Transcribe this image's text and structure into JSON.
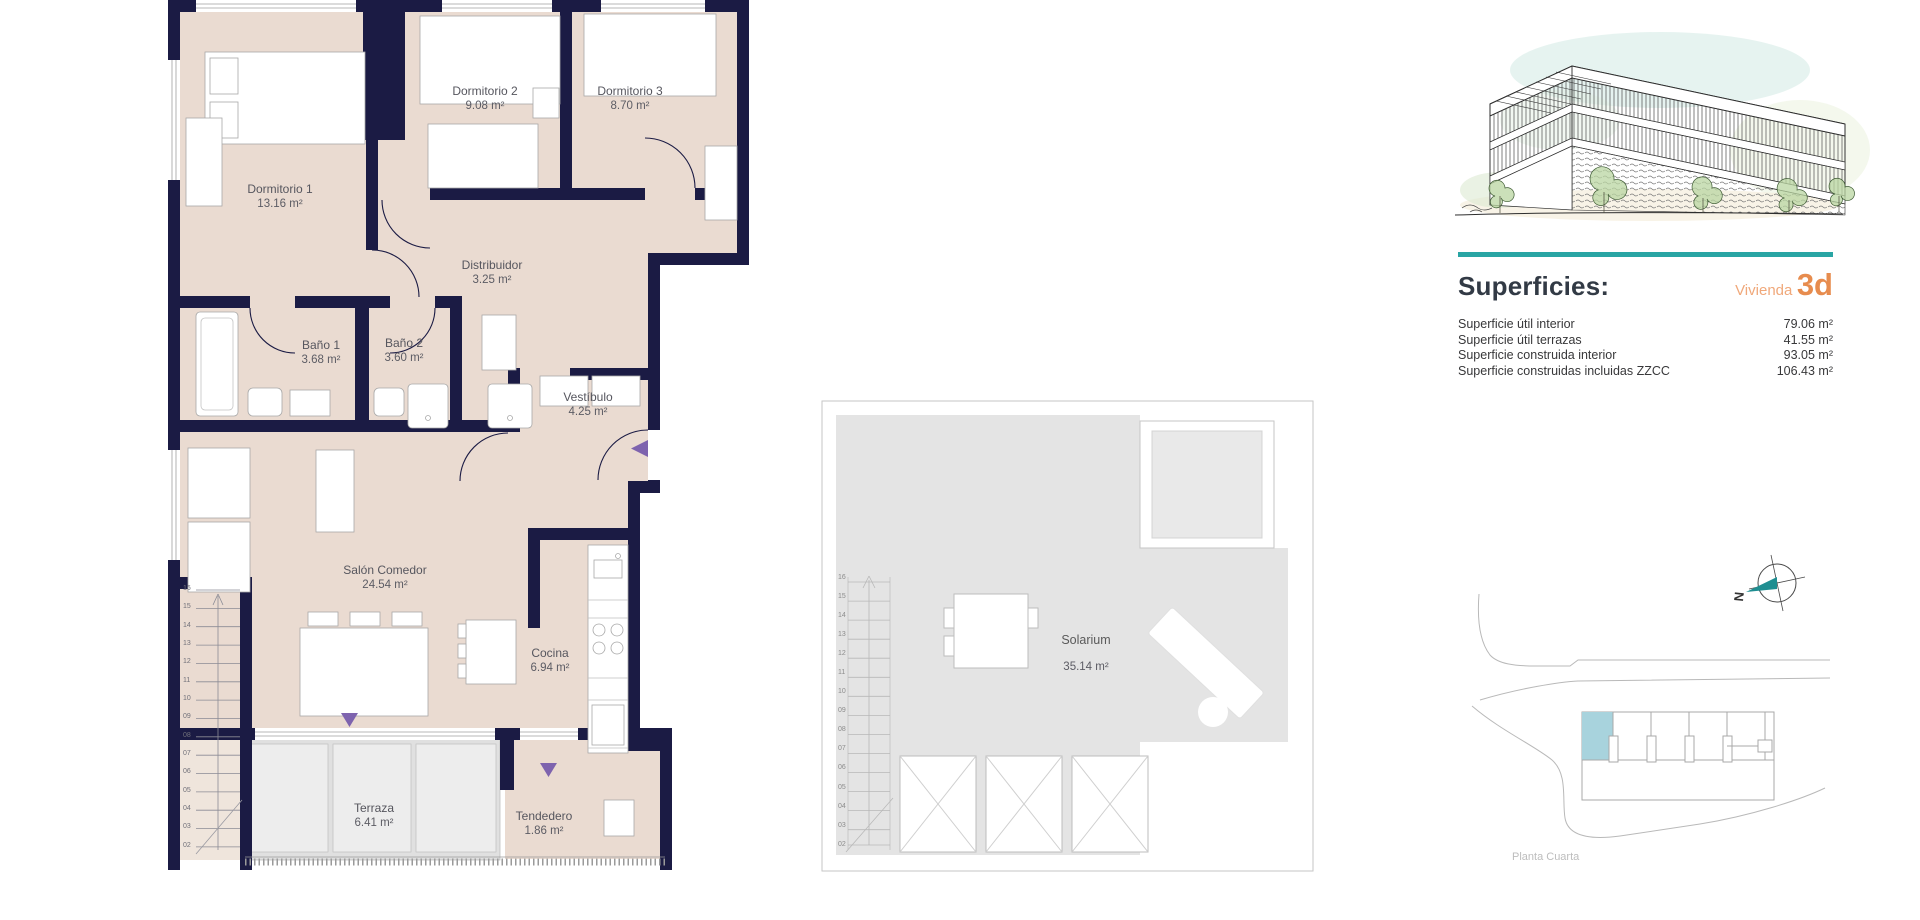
{
  "apartment_plan": {
    "rooms": [
      {
        "name": "Dormitorio 1",
        "area": "13.16 m²"
      },
      {
        "name": "Dormitorio 2",
        "area": "9.08 m²"
      },
      {
        "name": "Dormitorio 3",
        "area": "8.70 m²"
      },
      {
        "name": "Distribuidor",
        "area": "3.25 m²"
      },
      {
        "name": "Baño 1",
        "area": "3.68 m²"
      },
      {
        "name": "Baño 2",
        "area": "3.60 m²"
      },
      {
        "name": "Vestíbulo",
        "area": "4.25 m²"
      },
      {
        "name": "Salón Comedor",
        "area": "24.54 m²"
      },
      {
        "name": "Cocina",
        "area": "6.94 m²"
      },
      {
        "name": "Terraza",
        "area": "6.41 m²"
      },
      {
        "name": "Tendedero",
        "area": "1.86 m²"
      }
    ],
    "stair_numbers": [
      "16",
      "15",
      "14",
      "13",
      "12",
      "11",
      "10",
      "09",
      "08",
      "07",
      "06",
      "05",
      "04",
      "03",
      "02"
    ]
  },
  "solarium_plan": {
    "room": {
      "name": "Solarium",
      "area": "35.14 m²"
    },
    "stair_numbers": [
      "16",
      "15",
      "14",
      "13",
      "12",
      "11",
      "10",
      "09",
      "08",
      "07",
      "06",
      "05",
      "04",
      "03",
      "02"
    ]
  },
  "surfaces_panel": {
    "heading": "Superficies:",
    "unit_label": "Vivienda",
    "unit_id": "3d",
    "rows": [
      {
        "label": "Superficie útil interior",
        "value": "79.06 m²"
      },
      {
        "label": "Superficie útil terrazas",
        "value": "41.55 m²"
      },
      {
        "label": "Superficie construida interior",
        "value": "93.05 m²"
      },
      {
        "label": "Superficie construidas incluidas ZZCC",
        "value": "106.43 m²"
      }
    ]
  },
  "site_plan": {
    "caption": "Planta Cuarta",
    "compass_label": "N"
  },
  "colors": {
    "wall": "#1b1b44",
    "room_fill": "#eadbd1",
    "terrace_fill": "#e2e2e2",
    "accent_teal": "#29a5a4",
    "accent_orange": "#e78c4e",
    "accent_orange_light": "#f0a87a",
    "arrow_purple": "#7e63ae",
    "site_highlight": "#a8d3dd"
  }
}
